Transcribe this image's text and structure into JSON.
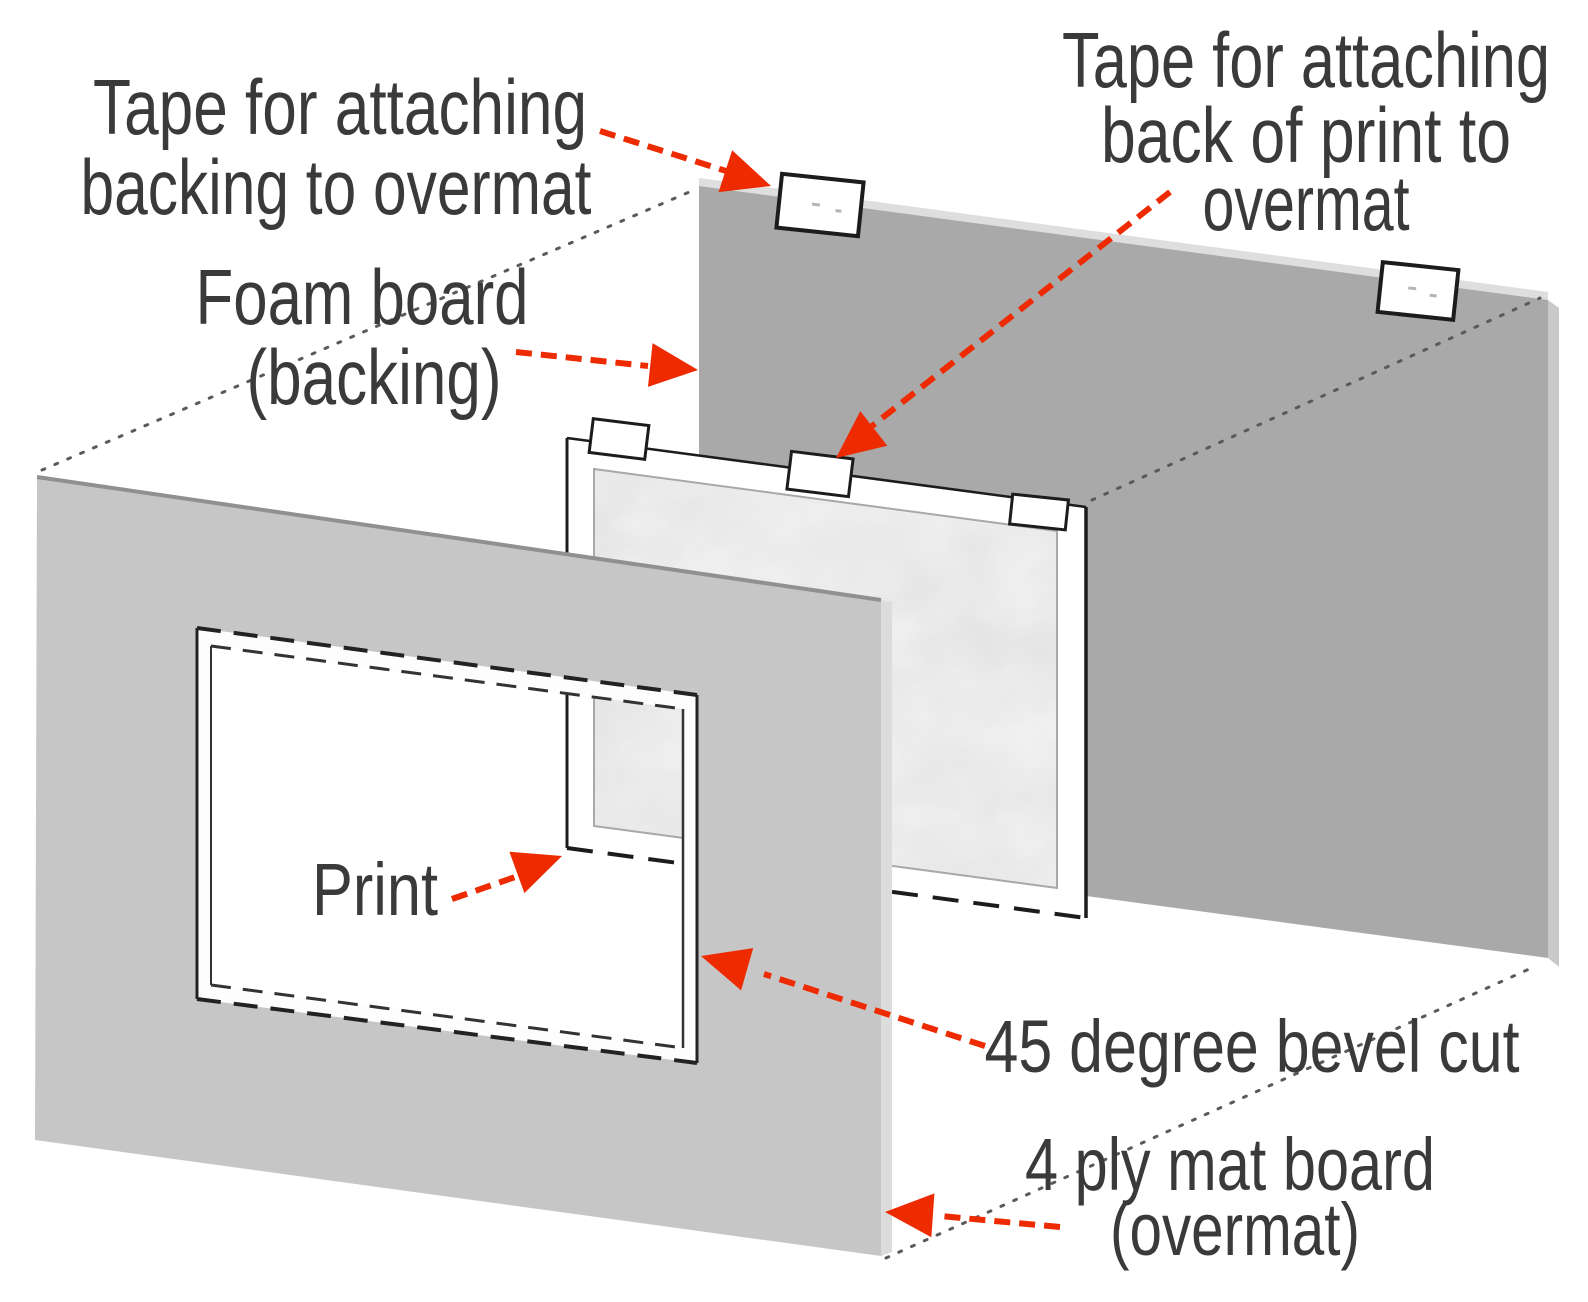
{
  "title": "Exploded diagram of matting a print (overmat, print, foam board backing)",
  "colors": {
    "accent_red": "#ee2a00",
    "foam_gray": "#a9a9a9",
    "foam_edge_light": "#dedede",
    "foam_side_light": "#c9c9c9",
    "overmat_gray": "#c6c6c6",
    "overmat_edge_light": "#dcdcdc",
    "bevel_white": "#fdfdfd",
    "marble_light": "#f1f1f1",
    "outline_dark": "#1c1c1c",
    "text_gray": "#3a3a3a",
    "background": "#ffffff"
  },
  "labels": {
    "tape_backing": {
      "line1": "Tape for attaching",
      "line2": "backing to overmat"
    },
    "foam_board": {
      "line1": "Foam board",
      "line2": "(backing)"
    },
    "tape_print": {
      "line1": "Tape for attaching",
      "line2": "back of print to",
      "line3": "overmat"
    },
    "print": {
      "text": "Print"
    },
    "bevel_cut": {
      "text": "45 degree bevel cut"
    },
    "overmat": {
      "line1": "4 ply mat board",
      "line2": "(overmat)"
    }
  }
}
